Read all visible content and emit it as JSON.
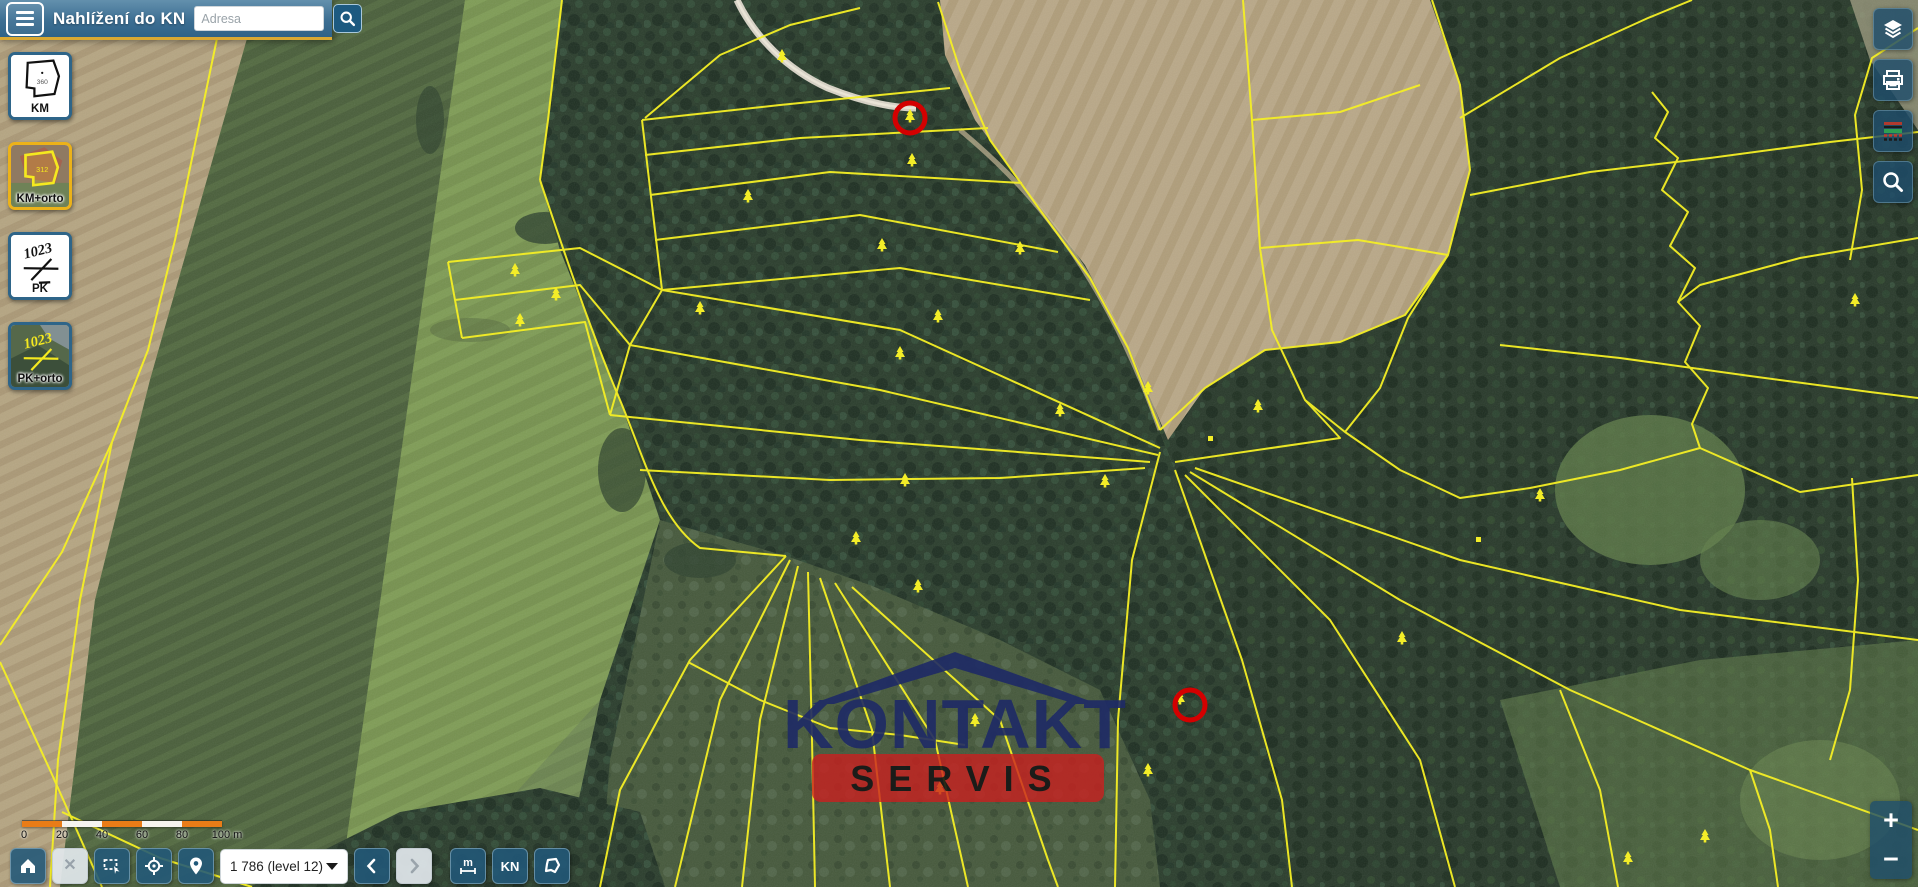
{
  "app": {
    "title": "Nahlížení do KN"
  },
  "topbar": {
    "search_placeholder": "Adresa",
    "search_value": ""
  },
  "layer_panel": {
    "items": [
      {
        "id": "km",
        "label": "KM",
        "thumb_text": "360",
        "selected": false
      },
      {
        "id": "km-orto",
        "label": "KM+orto",
        "thumb_text": "312",
        "selected": true
      },
      {
        "id": "pk",
        "label": "PK",
        "thumb_text": "1023",
        "selected": false
      },
      {
        "id": "pk-orto",
        "label": "PK+orto",
        "thumb_text": "1023",
        "selected": false
      }
    ]
  },
  "right_toolbar": {
    "buttons": [
      {
        "name": "layers"
      },
      {
        "name": "print"
      },
      {
        "name": "legend"
      },
      {
        "name": "search-area"
      }
    ]
  },
  "scalebar": {
    "ticks": [
      "0",
      "20",
      "40",
      "60",
      "80",
      "100 m"
    ],
    "bar_color": "#e97c17"
  },
  "bottom_toolbar": {
    "scale_select_value": "1 786 (level 12)",
    "measure_label": "m",
    "kn_label": "KN",
    "clear_label": "✕",
    "back_label": "‹",
    "forward_label": "›",
    "disabled_buttons": [
      "clear-selection",
      "history-forward"
    ]
  },
  "zoom_controls": {
    "zoom_in": "+",
    "zoom_out": "−"
  },
  "watermark": {
    "line1": "KONTAKT",
    "line2": "SERVIS",
    "primary_color": "#1e2a66",
    "band_color": "#cb1f1f"
  },
  "map": {
    "parcel_line_color": "#f5ef25",
    "highlight_color": "#d40000",
    "highlight_count": 2,
    "landuse_symbol": "coniferous-tree"
  }
}
